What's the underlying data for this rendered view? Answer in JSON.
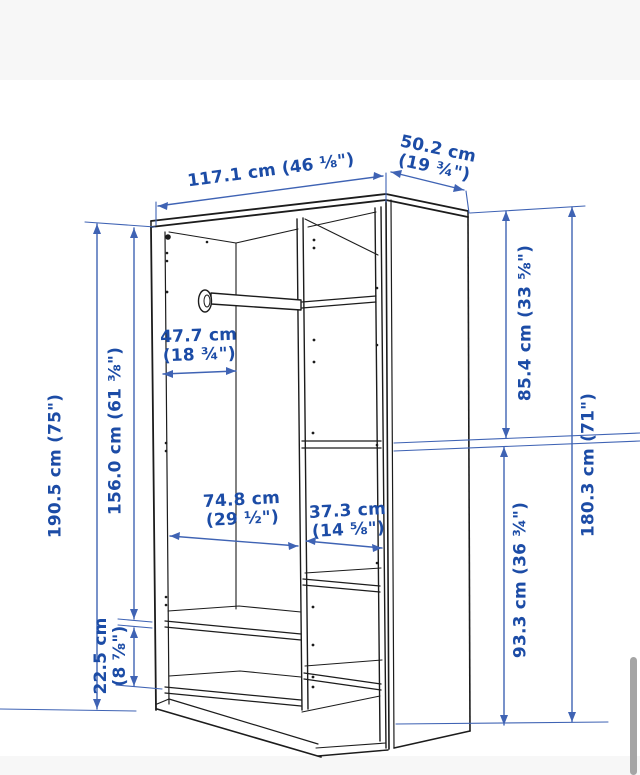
{
  "diagram": {
    "subject": "wardrobe dimension drawing",
    "units": [
      "cm",
      "inches"
    ]
  },
  "colors": {
    "dimension_text": "#1c4ca6",
    "dimension_line": "#3f63b4",
    "drawing_line": "#1c1c1c",
    "background": "#ffffff",
    "background_band": "#f7f7f7",
    "scrollbar": "#a5a5a5"
  },
  "dimensions": {
    "overall_width": "117.1 cm (46 ⅛\")",
    "depth_line1": "50.2 cm",
    "depth_line2": "(19 ¾\")",
    "overall_height": "190.5 cm (75\")",
    "interior_height_left": "156.0 cm (61 ⅜\")",
    "rail_depth_line1": "47.7 cm",
    "rail_depth_line2": "(18 ¾\")",
    "left_section_width_line1": "74.8 cm",
    "left_section_width_line2": "(29 ½\")",
    "right_section_width_line1": "37.3 cm",
    "right_section_width_line2": "(14 ⅝\")",
    "upper_right_section_height": "85.4 cm (33 ⅝\")",
    "lower_right_section_height": "93.3 cm (36 ¾\")",
    "interior_height_right": "180.3 cm (71\")",
    "plinth_height_line1": "22.5 cm",
    "plinth_height_line2": "(8 ⅞\")"
  }
}
